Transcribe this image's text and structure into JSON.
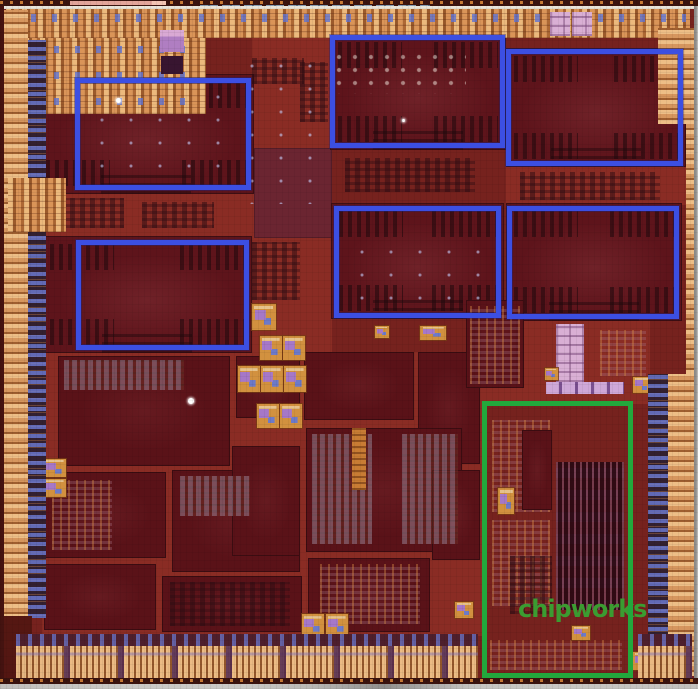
{
  "image": {
    "kind": "silicon die photograph",
    "description": "Chip die shot with six blue-outlined core blocks and one green-outlined block, chipworks watermark",
    "width": 698,
    "height": 689,
    "base_color": "#76221e"
  },
  "colors": {
    "annotation_blue": "#3c4fe2",
    "annotation_green": "#22a83c",
    "watermark_green": "#3b9c31",
    "pad_ring_tan": "#cf9155",
    "core_dark": "#5e141b",
    "channel_red": "#8a2c24",
    "scribe_gray": "#c6c5c2"
  },
  "watermark": {
    "text": "chipworks",
    "x": 518,
    "y": 597,
    "font_size": 24,
    "letter_spacing": -1,
    "color": "#3b9c31"
  },
  "annotations": {
    "blue_boxes": [
      {
        "name": "blue-box-top-left",
        "x": 75,
        "y": 78,
        "w": 176,
        "h": 112
      },
      {
        "name": "blue-box-top-mid",
        "x": 330,
        "y": 35,
        "w": 175,
        "h": 113
      },
      {
        "name": "blue-box-top-right",
        "x": 506,
        "y": 49,
        "w": 177,
        "h": 117
      },
      {
        "name": "blue-box-row2-left",
        "x": 76,
        "y": 240,
        "w": 173,
        "h": 110
      },
      {
        "name": "blue-box-row2-mid",
        "x": 334,
        "y": 206,
        "w": 167,
        "h": 112
      },
      {
        "name": "blue-box-row2-right",
        "x": 507,
        "y": 206,
        "w": 172,
        "h": 113
      }
    ],
    "green_box": {
      "name": "green-box-bottom-right",
      "x": 482,
      "y": 401,
      "w": 151,
      "h": 277
    }
  },
  "patches": [
    [
      44,
      150,
      210,
      88,
      "channel",
      "channel-left-mid"
    ],
    [
      252,
      36,
      80,
      318,
      "channel",
      "channel-center-column"
    ],
    [
      42,
      352,
      440,
      284,
      "channel",
      "channel-central-mosaic"
    ],
    [
      480,
      318,
      170,
      86,
      "channel",
      "channel-right-mid"
    ],
    [
      506,
      166,
      184,
      39,
      "channel",
      "channel-under-core3"
    ],
    [
      254,
      148,
      78,
      90,
      "mauve",
      "mauve-block-center"
    ],
    [
      38,
      74,
      216,
      120,
      "core",
      "gpu-core-1"
    ],
    [
      330,
      34,
      176,
      116,
      "core",
      "gpu-core-2"
    ],
    [
      506,
      48,
      180,
      119,
      "core",
      "gpu-core-3"
    ],
    [
      42,
      236,
      210,
      117,
      "core",
      "gpu-core-4"
    ],
    [
      331,
      203,
      173,
      116,
      "core",
      "gpu-core-5"
    ],
    [
      506,
      203,
      176,
      118,
      "core",
      "gpu-core-6"
    ],
    [
      58,
      356,
      172,
      110,
      "block",
      "logic-block-1"
    ],
    [
      236,
      356,
      64,
      62,
      "block",
      "logic-block-2"
    ],
    [
      304,
      352,
      110,
      68,
      "block",
      "logic-block-3"
    ],
    [
      418,
      352,
      62,
      112,
      "block",
      "logic-block-4"
    ],
    [
      44,
      472,
      122,
      86,
      "block",
      "logic-block-5"
    ],
    [
      172,
      470,
      128,
      102,
      "block",
      "logic-block-6"
    ],
    [
      306,
      428,
      156,
      124,
      "block",
      "logic-block-7"
    ],
    [
      44,
      564,
      112,
      66,
      "block",
      "logic-block-8"
    ],
    [
      162,
      576,
      140,
      56,
      "block",
      "logic-block-9"
    ],
    [
      308,
      558,
      122,
      74,
      "block",
      "logic-block-10"
    ],
    [
      432,
      470,
      48,
      90,
      "block",
      "logic-block-11"
    ],
    [
      232,
      446,
      68,
      110,
      "block",
      "logic-block-12"
    ],
    [
      252,
      58,
      52,
      26,
      "sramd",
      "sram-patch-a"
    ],
    [
      300,
      62,
      28,
      60,
      "sramd",
      "sram-patch-b"
    ],
    [
      252,
      242,
      48,
      58,
      "sramd",
      "sram-patch-c"
    ],
    [
      60,
      198,
      64,
      30,
      "sramd",
      "sram-patch-d"
    ],
    [
      142,
      202,
      72,
      26,
      "sramd",
      "sram-patch-e"
    ],
    [
      345,
      158,
      130,
      34,
      "sramd",
      "sram-patch-f"
    ],
    [
      520,
      172,
      140,
      28,
      "sramd",
      "sram-patch-g"
    ],
    [
      312,
      434,
      60,
      110,
      "sramg",
      "sram-patch-h"
    ],
    [
      402,
      434,
      56,
      110,
      "sramg",
      "sram-patch-i"
    ],
    [
      64,
      360,
      120,
      30,
      "sramg",
      "sram-patch-j"
    ],
    [
      180,
      476,
      70,
      40,
      "sramg",
      "sram-patch-k"
    ],
    [
      52,
      480,
      60,
      70,
      "sramo",
      "sram-patch-l"
    ],
    [
      320,
      564,
      100,
      60,
      "sramo",
      "sram-patch-m"
    ],
    [
      170,
      582,
      120,
      44,
      "sramd",
      "sram-patch-n"
    ],
    [
      352,
      428,
      14,
      62,
      "obar",
      "orange-bar"
    ],
    [
      336,
      54,
      130,
      40,
      "marks",
      "fiducial-marks"
    ],
    [
      100,
      95,
      130,
      80,
      "specks",
      "metal-specks-1"
    ],
    [
      250,
      64,
      80,
      140,
      "specks",
      "metal-specks-2"
    ],
    [
      360,
      250,
      120,
      60,
      "specks",
      "metal-specks-3"
    ],
    [
      466,
      300,
      58,
      88,
      "block",
      "right-mid-block"
    ],
    [
      470,
      306,
      50,
      78,
      "sramo",
      "right-mid-sram"
    ],
    [
      556,
      324,
      28,
      58,
      "pink",
      "pink-sram-block"
    ],
    [
      546,
      382,
      78,
      12,
      "lav",
      "lavender-sram-row"
    ],
    [
      600,
      330,
      46,
      46,
      "sramo",
      "right-sram-array"
    ],
    [
      545,
      368,
      13,
      12,
      "pll",
      "analog-block-20"
    ],
    [
      556,
      462,
      68,
      148,
      "stripesv",
      "green-area-stripe-array"
    ],
    [
      492,
      420,
      58,
      92,
      "sramo",
      "green-area-sram-1"
    ],
    [
      492,
      520,
      58,
      86,
      "sramo",
      "green-area-sram-2"
    ],
    [
      522,
      430,
      30,
      80,
      "block",
      "green-area-block"
    ],
    [
      510,
      556,
      42,
      58,
      "sramd",
      "green-area-sram-3"
    ],
    [
      490,
      640,
      132,
      30,
      "sramo",
      "green-area-bottom-sram"
    ],
    [
      498,
      488,
      16,
      26,
      "pll",
      "green-area-analog"
    ],
    [
      252,
      304,
      24,
      26,
      "pll",
      "analog-block-1"
    ],
    [
      260,
      336,
      22,
      24,
      "pll",
      "analog-block-2"
    ],
    [
      283,
      336,
      22,
      24,
      "pll",
      "analog-block-3"
    ],
    [
      238,
      366,
      22,
      26,
      "pll",
      "analog-block-4"
    ],
    [
      261,
      366,
      22,
      26,
      "pll",
      "analog-block-5"
    ],
    [
      284,
      366,
      22,
      26,
      "pll",
      "analog-block-6"
    ],
    [
      257,
      404,
      22,
      24,
      "pll",
      "analog-block-7"
    ],
    [
      280,
      404,
      22,
      24,
      "pll",
      "analog-block-8"
    ],
    [
      375,
      326,
      14,
      12,
      "pll",
      "analog-block-9"
    ],
    [
      420,
      326,
      26,
      14,
      "pll",
      "analog-block-10"
    ],
    [
      302,
      614,
      22,
      22,
      "pll",
      "analog-block-11"
    ],
    [
      326,
      614,
      22,
      22,
      "pll",
      "analog-block-12"
    ],
    [
      44,
      459,
      22,
      18,
      "pll",
      "analog-block-13"
    ],
    [
      44,
      479,
      22,
      18,
      "pll",
      "analog-block-14"
    ],
    [
      633,
      377,
      18,
      16,
      "pll",
      "analog-block-15"
    ],
    [
      633,
      652,
      18,
      18,
      "pll",
      "analog-block-16"
    ],
    [
      572,
      626,
      18,
      14,
      "pll",
      "analog-block-17"
    ],
    [
      455,
      602,
      18,
      16,
      "pll",
      "analog-block-18"
    ],
    [
      6,
      9,
      684,
      29,
      "padh",
      "pad-ring-top"
    ],
    [
      10,
      14,
      676,
      8,
      "cellsh",
      "pad-ring-top-cells"
    ],
    [
      8,
      38,
      198,
      76,
      "padh",
      "pad-cluster-top-left"
    ],
    [
      12,
      46,
      188,
      7,
      "cellsh",
      "pad-cluster-cells-1"
    ],
    [
      12,
      72,
      188,
      7,
      "cellsh",
      "pad-cluster-cells-2"
    ],
    [
      12,
      98,
      188,
      7,
      "cellsh",
      "pad-cluster-cells-3"
    ],
    [
      160,
      30,
      24,
      22,
      "purple",
      "purple-block-top"
    ],
    [
      161,
      56,
      22,
      18,
      "dpurple",
      "dark-purple-block"
    ],
    [
      550,
      12,
      20,
      24,
      "pink",
      "lavender-pad-1"
    ],
    [
      572,
      12,
      20,
      24,
      "pink",
      "lavender-pad-2"
    ],
    [
      658,
      28,
      36,
      96,
      "padv",
      "pad-cluster-top-right"
    ],
    [
      2,
      10,
      26,
      608,
      "padv",
      "pad-column-left"
    ],
    [
      28,
      40,
      18,
      578,
      "cellsv",
      "cell-column-left"
    ],
    [
      8,
      178,
      58,
      54,
      "padh",
      "pad-cluster-left-2"
    ],
    [
      686,
      42,
      8,
      332,
      "padv",
      "pad-column-right-thin"
    ],
    [
      648,
      374,
      20,
      302,
      "cellsv",
      "cell-column-right"
    ],
    [
      668,
      374,
      26,
      302,
      "padv",
      "pad-column-right-wide"
    ],
    [
      2,
      616,
      30,
      62,
      "darkc",
      "corner-bottom-left"
    ],
    [
      16,
      634,
      462,
      12,
      "cellsb",
      "cell-row-bottom-left"
    ],
    [
      16,
      646,
      462,
      32,
      "padb",
      "pad-row-bottom-left"
    ],
    [
      638,
      634,
      54,
      12,
      "cellsb",
      "cell-row-bottom-right"
    ],
    [
      638,
      646,
      54,
      32,
      "padb",
      "pad-row-bottom-right"
    ],
    [
      0,
      0,
      698,
      6,
      "edge",
      "scribe-top"
    ],
    [
      70,
      1,
      85,
      4,
      "segpink",
      "scribe-pink-segment"
    ],
    [
      152,
      1,
      14,
      4,
      "segsalmon",
      "scribe-salmon-segment"
    ],
    [
      200,
      5,
      230,
      3,
      "segblue",
      "scribe-blue-segment"
    ],
    [
      4,
      6,
      690,
      3,
      "white",
      "scribe-white-line"
    ],
    [
      0,
      6,
      4,
      678,
      "louter",
      "edge-left-outer"
    ],
    [
      694,
      6,
      4,
      683,
      "router",
      "edge-right-outer"
    ],
    [
      0,
      678,
      698,
      7,
      "edge",
      "scribe-bottom"
    ],
    [
      0,
      684,
      698,
      5,
      "gray",
      "scribe-gray-band"
    ],
    [
      116,
      98,
      5,
      5,
      "dot",
      "white-dot-1"
    ],
    [
      188,
      398,
      6,
      6,
      "dot",
      "white-dot-2"
    ],
    [
      402,
      119,
      3,
      3,
      "dot",
      "white-dot-3"
    ]
  ]
}
